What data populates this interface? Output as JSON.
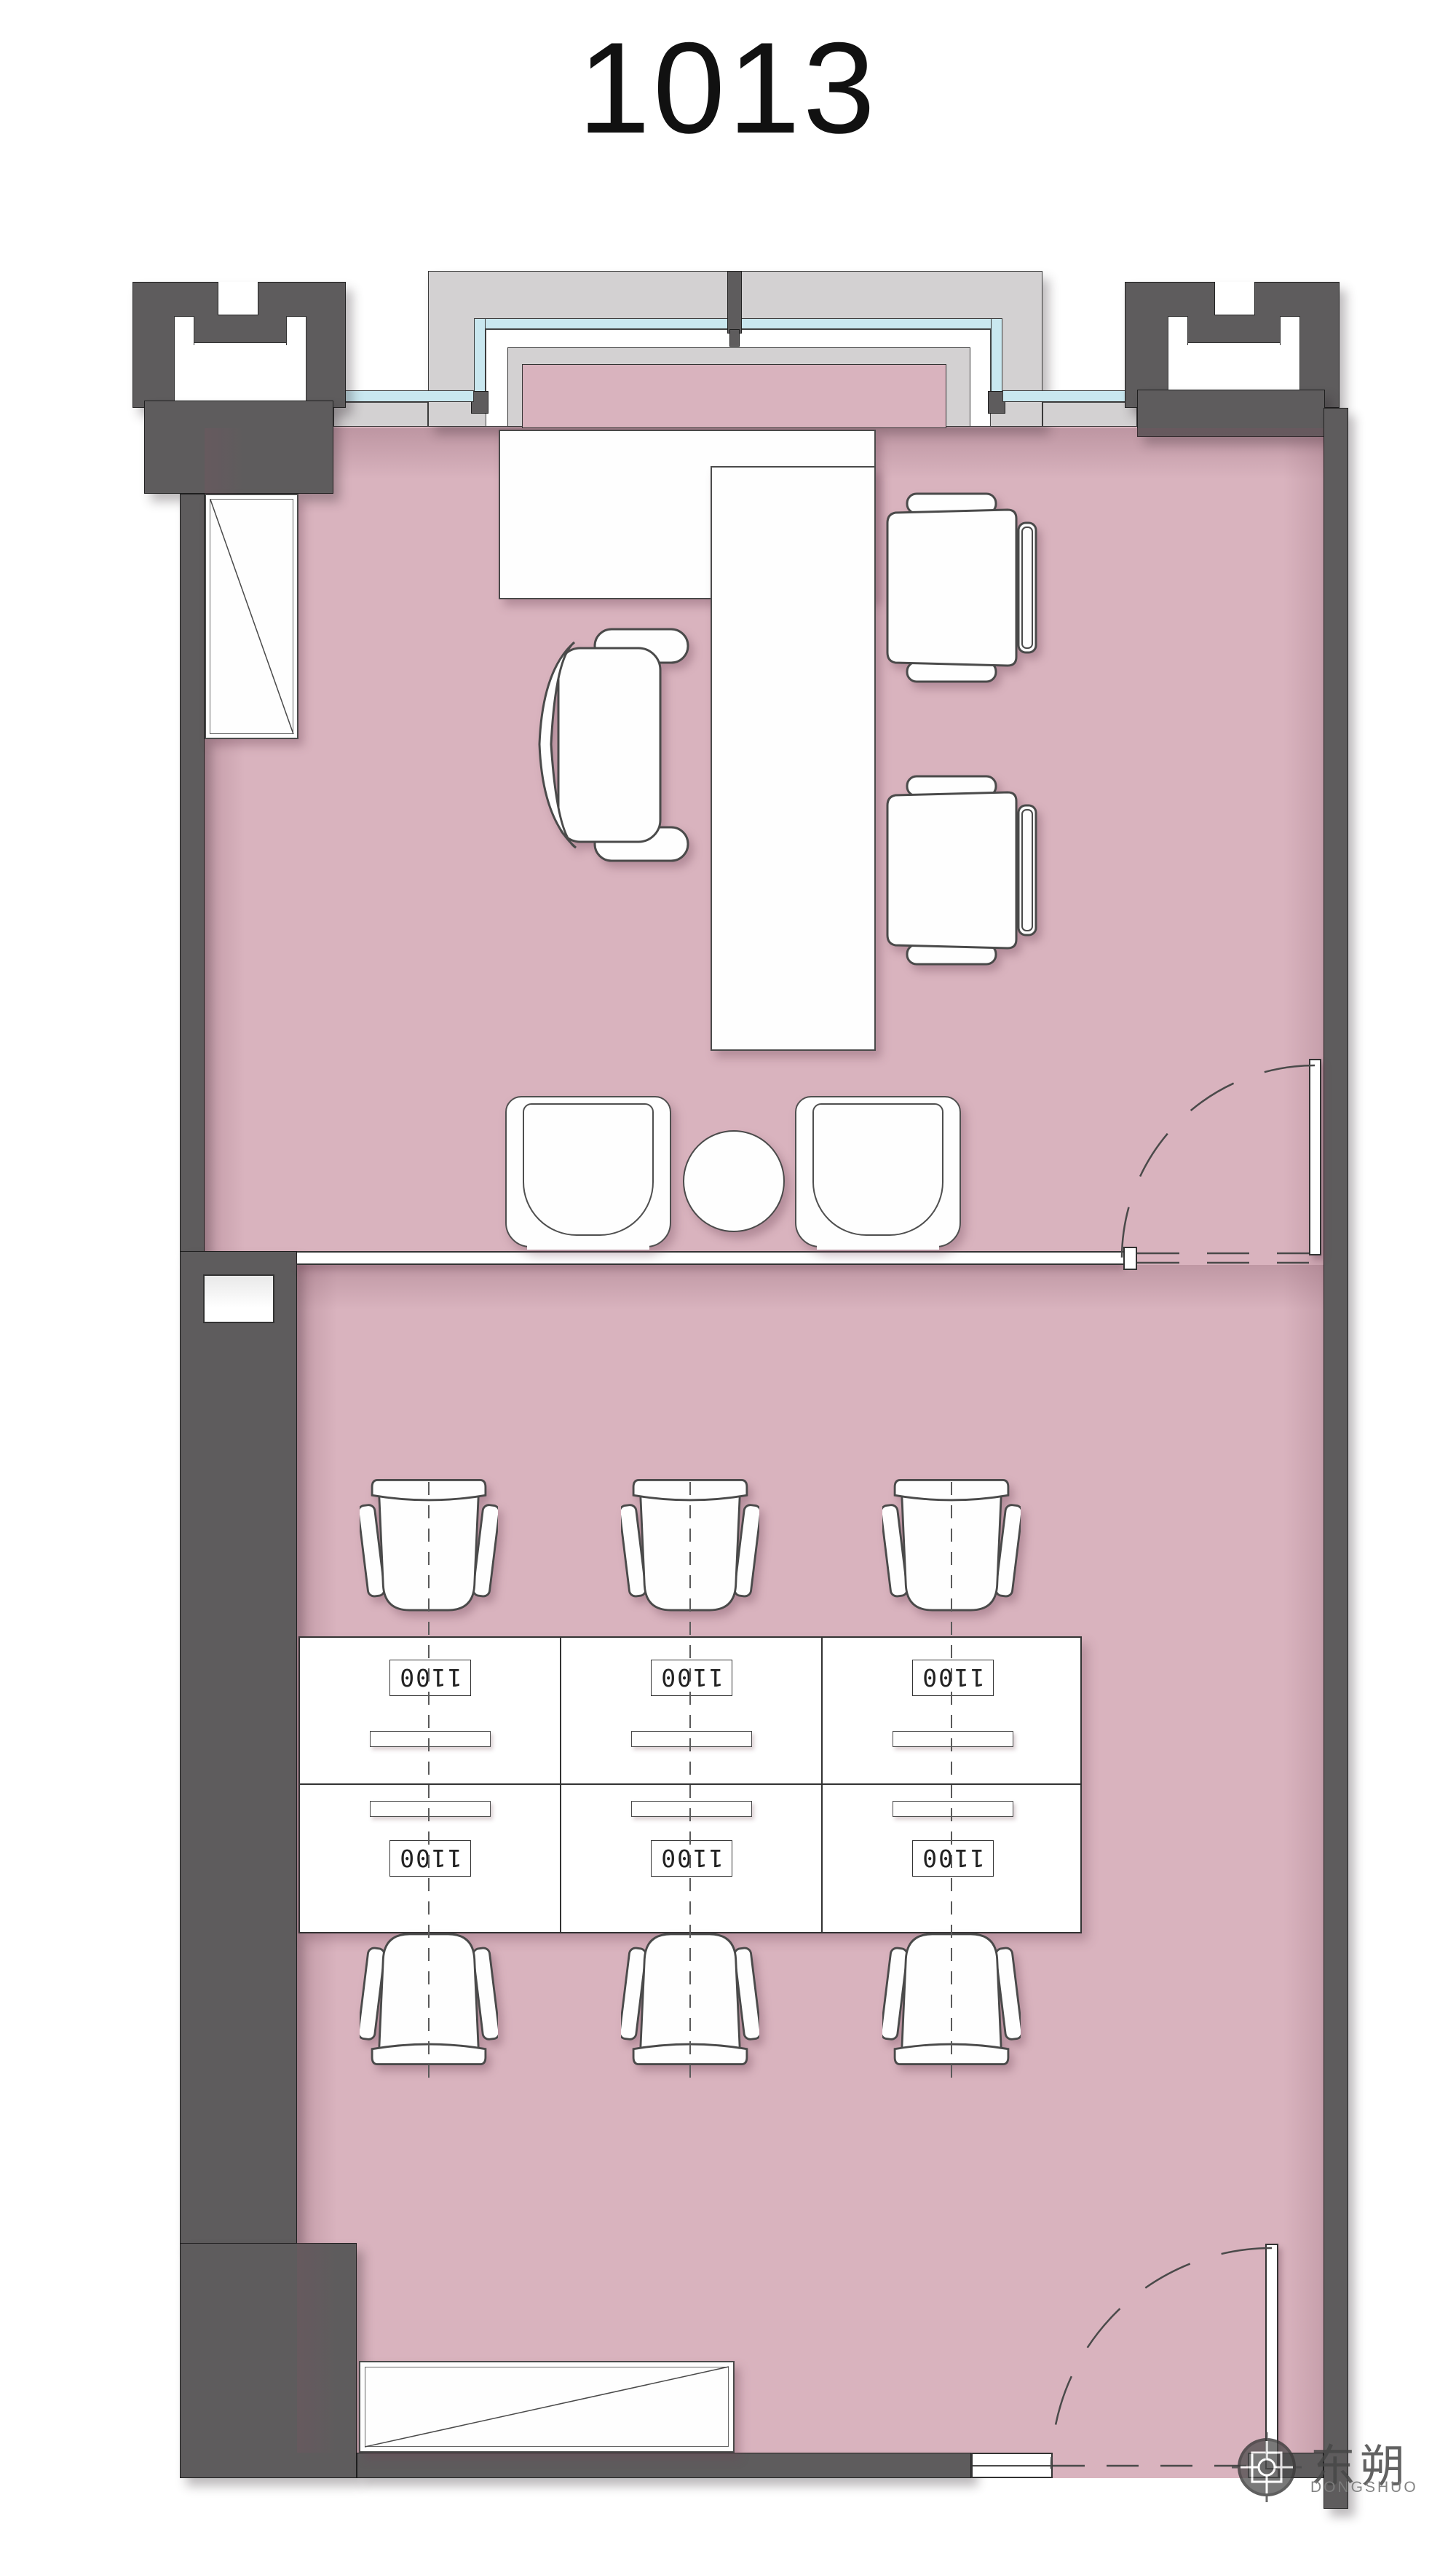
{
  "title": "1013",
  "colors": {
    "floor_pink": "#d9b3be",
    "wall_dark": "#5e5c5d",
    "exterior_gray": "#d3d1d2",
    "window_glazing": "#c9e7ef",
    "furniture_outline": "#4a4a4a"
  },
  "rooms": {
    "upper": "private office with L-desk, executive chair, two guest chairs, lounge chairs and round table",
    "lower": "open office with six workstations"
  },
  "workstations": {
    "rows": 2,
    "cols": 3,
    "cells": [
      {
        "label": "1100"
      },
      {
        "label": "1100"
      },
      {
        "label": "1100"
      },
      {
        "label": "1100"
      },
      {
        "label": "1100"
      },
      {
        "label": "1100"
      }
    ]
  },
  "logo": {
    "name_zh": "东朔",
    "name_en": "DONGSHUO"
  }
}
